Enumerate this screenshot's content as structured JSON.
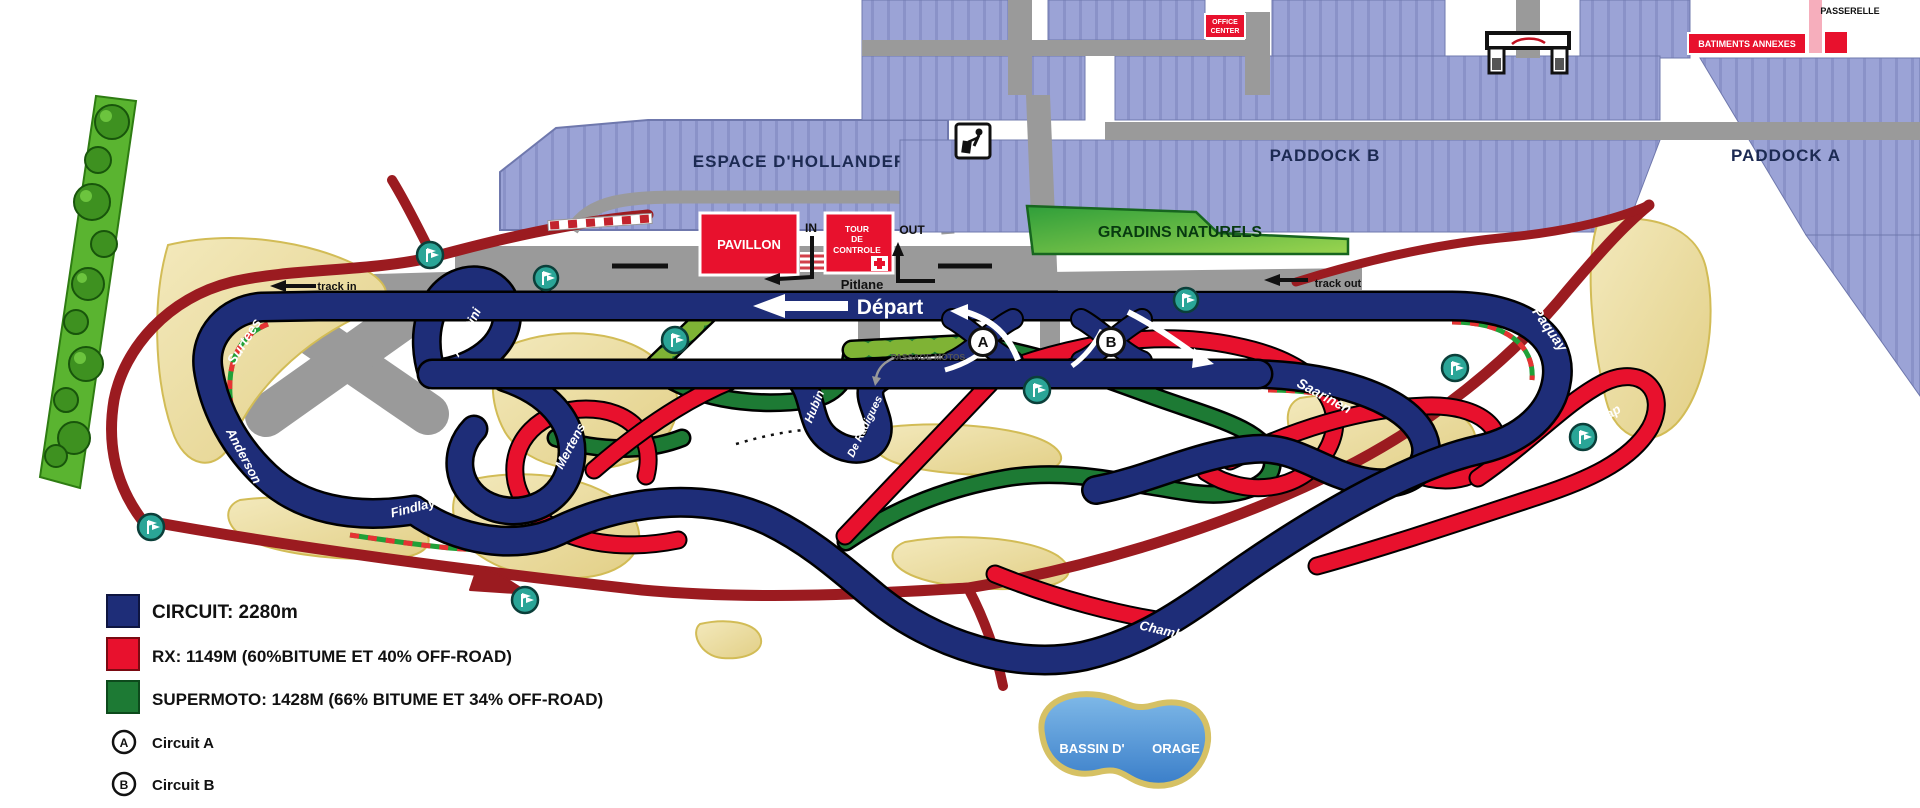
{
  "legend": {
    "items": [
      {
        "swatch_color": "#1e2d78",
        "label": "CIRCUIT: 2280m"
      },
      {
        "swatch_color": "#e8112d",
        "label": "RX: 1149M (60%BITUME ET 40% OFF-ROAD)"
      },
      {
        "swatch_color": "#1d7a34",
        "label": "SUPERMOTO: 1428M (66% BITUME ET 34% OFF-ROAD)"
      }
    ],
    "circuit_a": {
      "marker": "A",
      "label": "Circuit A"
    },
    "circuit_b": {
      "marker": "B",
      "label": "Circuit B"
    }
  },
  "buildings": {
    "espace_dhollander": "ESPACE D'HOLLANDER",
    "pavillon": "PAVILLON",
    "tour_de_controle_lines": [
      "TOUR",
      "DE",
      "CONTROLE"
    ],
    "office_center_lines": [
      "OFFICE",
      "CENTER"
    ],
    "paddock_a": "PADDOCK A",
    "paddock_b": "PADDOCK B",
    "gradins_naturels": "GRADINS NATURELS",
    "batiments_annexes": "BATIMENTS ANNEXES",
    "passerelle": "PASSERELLE",
    "bassin_dorage_lines": [
      "BASSIN D'",
      "ORAGE"
    ]
  },
  "labels": {
    "depart": "Départ",
    "pitlane": "Pitlane",
    "pit_in": "IN",
    "pit_out": "OUT",
    "track_in": "track in",
    "track_out": "track out",
    "passage_motos": "PASSAGE MOTOS"
  },
  "corners": {
    "surtees": "Surtees",
    "anderson": "Anderson",
    "findlay": "Findlay",
    "agostini": "Agostini",
    "mertens": "Mertens",
    "hubin": "Hubin",
    "de_radigues": "De Radigues",
    "chambon": "Chambon",
    "saarinen": "Saarinen",
    "paquay": "Paquay",
    "joker_lap": "Joker Lap"
  },
  "markers": {
    "a": "A",
    "b": "B"
  },
  "colors": {
    "circuit_blue": "#1e2d78",
    "rx_red": "#e8112d",
    "supermoto_green": "#1d7a34",
    "supermoto_offroad_green": "#7fb335",
    "access_road_darkred": "#9b1b20",
    "service_road_gray": "#9a9a9a",
    "building_lavender": "#9ba3d6",
    "runoff_tan": "#eee0a4",
    "marshal_teal": "#2aa597",
    "water_blue": "#4a8fd0",
    "grandstand_green": "#3fae49",
    "red_building": "#e8112d",
    "passerelle_pink": "#f6aebc"
  }
}
